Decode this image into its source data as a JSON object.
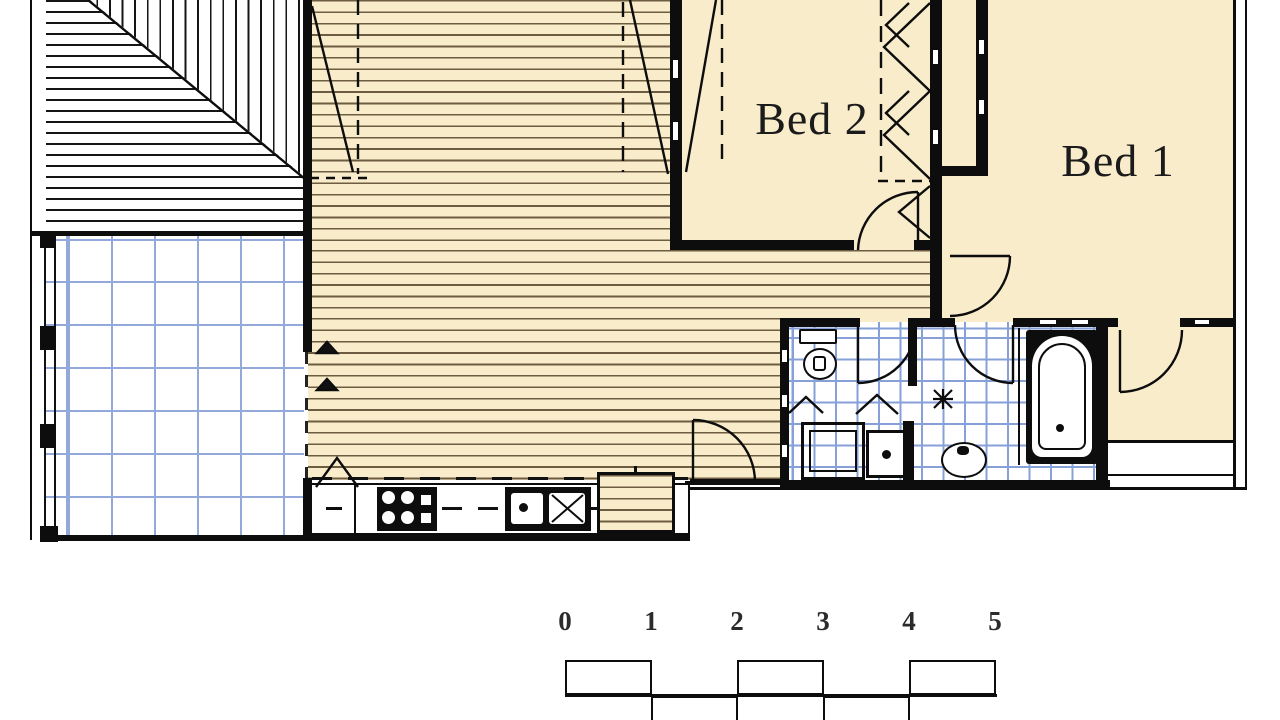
{
  "plan": {
    "type": "residential-floor-plan",
    "rooms": [
      {
        "id": "bed-2",
        "label": "Bed 2"
      },
      {
        "id": "bed-1",
        "label": "Bed 1"
      }
    ],
    "areas": [
      "deck",
      "tiled-patio",
      "living-dining",
      "kitchen",
      "bathroom",
      "laundry-wc",
      "entry-hall",
      "wardrobe"
    ],
    "fixtures": [
      "toilet",
      "shower",
      "laundry-tub",
      "basin",
      "bathtub",
      "cooktop",
      "sink",
      "fridge-space",
      "floor-waste"
    ],
    "scale_bar": {
      "unit_labels": [
        "0",
        "1",
        "2",
        "3",
        "4",
        "5"
      ]
    },
    "colors": {
      "floor_cream": "#F8ECCB",
      "floorboard_line": "#6E5C42",
      "wall": "#0D0D0D",
      "patio_tile_line": "#93A9DC",
      "bath_tile_line": "#87A0D8",
      "label_text": "#1B1B1B"
    }
  }
}
